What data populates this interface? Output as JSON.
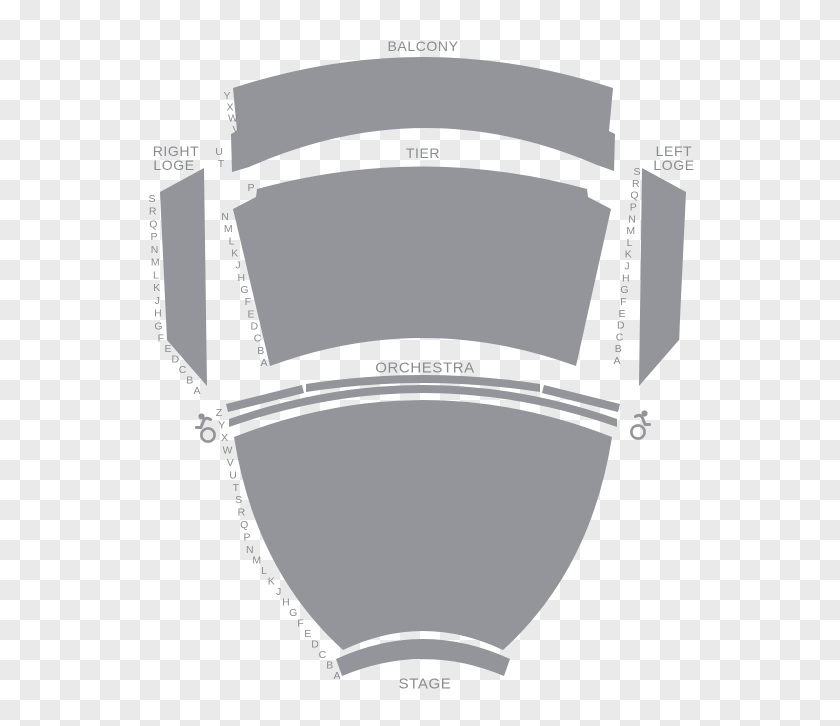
{
  "sections": {
    "balcony": {
      "label": "BALCONY",
      "rows_upper": [
        "Y",
        "X",
        "W",
        "V"
      ],
      "rows_lower": [
        "U",
        "T"
      ]
    },
    "tier": {
      "label": "TIER",
      "row_p": [
        "P"
      ],
      "rows": [
        "N",
        "M",
        "L",
        "K",
        "J",
        "H",
        "G",
        "F",
        "E",
        "D",
        "C",
        "B",
        "A"
      ]
    },
    "right_loge": {
      "label_line1": "RIGHT",
      "label_line2": "LOGE",
      "rows": [
        "S",
        "R",
        "Q",
        "P",
        "N",
        "M",
        "L",
        "K",
        "J",
        "H",
        "G",
        "F",
        "E",
        "D",
        "C",
        "B",
        "A"
      ]
    },
    "left_loge": {
      "label_line1": "LEFT",
      "label_line2": "LOGE",
      "rows": [
        "S",
        "R",
        "Q",
        "P",
        "N",
        "M",
        "L",
        "K",
        "J",
        "H",
        "G",
        "F",
        "E",
        "D",
        "C",
        "B",
        "A"
      ]
    },
    "orchestra": {
      "label": "ORCHESTRA",
      "rows": [
        "Z",
        "Y",
        "X",
        "W",
        "V",
        "U",
        "T",
        "S",
        "R",
        "Q",
        "P",
        "N",
        "M",
        "L",
        "K",
        "J",
        "H",
        "G",
        "F",
        "E",
        "D",
        "C",
        "B",
        "A"
      ]
    },
    "stage": {
      "label": "STAGE"
    }
  },
  "accessibility": {
    "left_icon": "wheelchair",
    "right_icon": "wheelchair"
  },
  "colors": {
    "section_fill": "#94959a",
    "label_text": "#8a8c90",
    "checker_light": "#ffffff",
    "checker_dark": "#eaeaea"
  }
}
